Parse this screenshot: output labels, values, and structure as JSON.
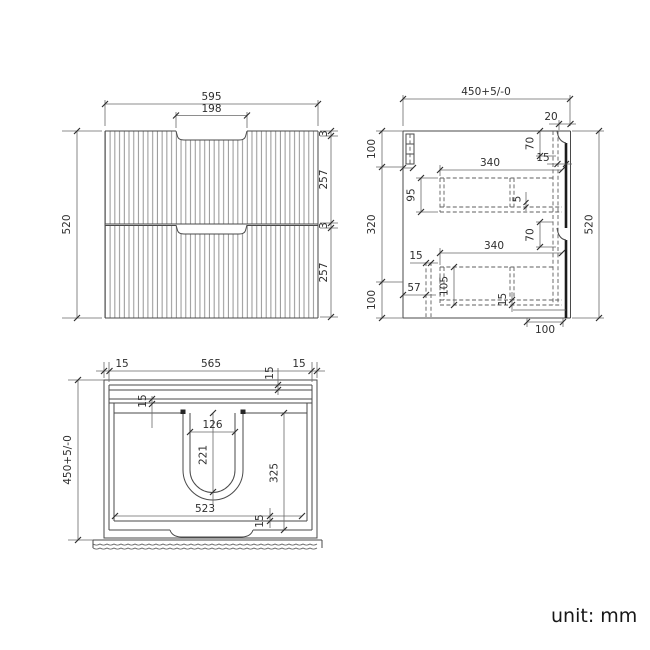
{
  "meta": {
    "unit_label": "unit: mm"
  },
  "front_view": {
    "overall_width": "595",
    "handle_cutout_width": "198",
    "overall_height": "520",
    "top_gap": "3",
    "drawer1_height": "257",
    "mid_gap": "3",
    "drawer2_height": "257"
  },
  "side_view": {
    "overall_depth": "450+5/-0",
    "front_panel_thickness": "20",
    "top_offset": "100",
    "mid_span": "320",
    "bottom_offset": "100",
    "overall_height": "520",
    "recess_height_top": "70",
    "front_thickness_top": "15",
    "drawer1_depth": "340",
    "drawer1_side_height": "95",
    "bottom_clearance": "5",
    "recess_height_mid": "70",
    "drawer2_depth": "340",
    "rail_thickness": "15",
    "back_offset": "57",
    "drawer2_side_height": "105",
    "bottom_panel_thickness": "15",
    "bottom_front_offset": "100"
  },
  "plan_view": {
    "left_wall": "15",
    "inner_width": "565",
    "right_wall": "15",
    "back_gap_left": "15",
    "back_gap_right": "15",
    "overall_depth": "450+5/-0",
    "cutout_width": "126",
    "cutout_depth": "221",
    "front_span": "325",
    "inner_front_width": "523",
    "front_wall": "15"
  }
}
